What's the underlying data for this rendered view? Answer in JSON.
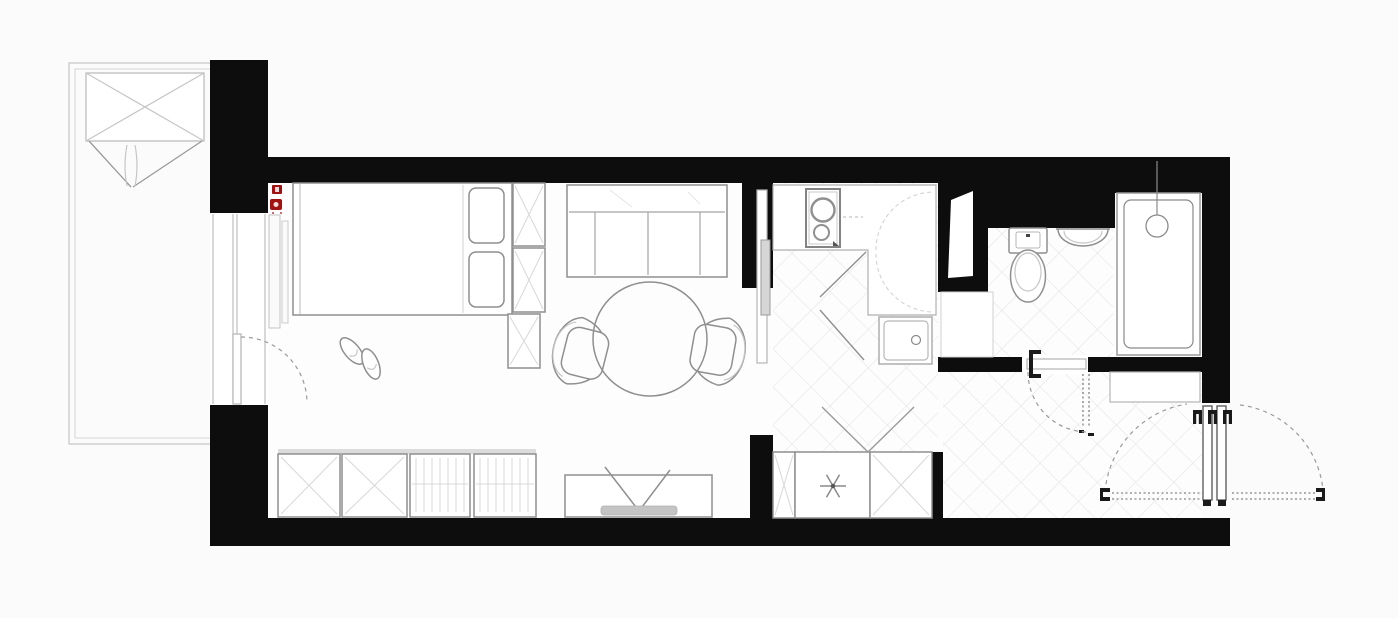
{
  "canvas": {
    "width": 1398,
    "height": 618,
    "background": "#fbfbfb"
  },
  "palette": {
    "wall": "#0d0d0d",
    "furniture_stroke": "#8f8f8f",
    "light_stroke": "#c6c6c6",
    "tile_line": "#e2e2e2",
    "accent_red": "#a01212",
    "tv_base_gray": "#c4c4c4",
    "fixture_fill": "#ffffff"
  },
  "plan": {
    "type": "studio-apartment-floor-plan",
    "visible_text": "",
    "rooms": [
      {
        "id": "balcony",
        "side": "left",
        "features": [
          "awning-box-with-cross",
          "fold-lines"
        ]
      },
      {
        "id": "living-sleeping-area",
        "side": "center-left",
        "features": [
          "double-bed",
          "two-pillows",
          "wardrobe-column",
          "sofa",
          "round-dining-table",
          "two-armchairs",
          "tv-console",
          "four-storage-cabinets",
          "slippers",
          "radiator",
          "balcony-window-and-door"
        ]
      },
      {
        "id": "kitchen",
        "side": "center-right",
        "features": [
          "l-shaped-counter",
          "cooktop-two-burners",
          "corner-carousel-arcs",
          "square-sink",
          "sliding-door",
          "diagonal-tiled-floor"
        ]
      },
      {
        "id": "hallway",
        "side": "right-bottom",
        "features": [
          "built-in-closet",
          "washing-machine-asterisk",
          "entrance-double-door-with-swing-arcs",
          "low-cabinet",
          "diagonal-tiled-floor"
        ]
      },
      {
        "id": "bathroom",
        "side": "right-top",
        "features": [
          "toilet",
          "semicircular-washbasin",
          "bathtub",
          "shower-head",
          "hinged-door-with-swing-arc",
          "duct-niche",
          "diagonal-tiled-floor"
        ]
      }
    ],
    "annotations": {
      "red_wall_markers": 2,
      "door_swing_arcs": 5,
      "doors": [
        "balcony-door",
        "sliding-door-kitchen",
        "bathroom-door",
        "entrance-double-door"
      ]
    }
  }
}
